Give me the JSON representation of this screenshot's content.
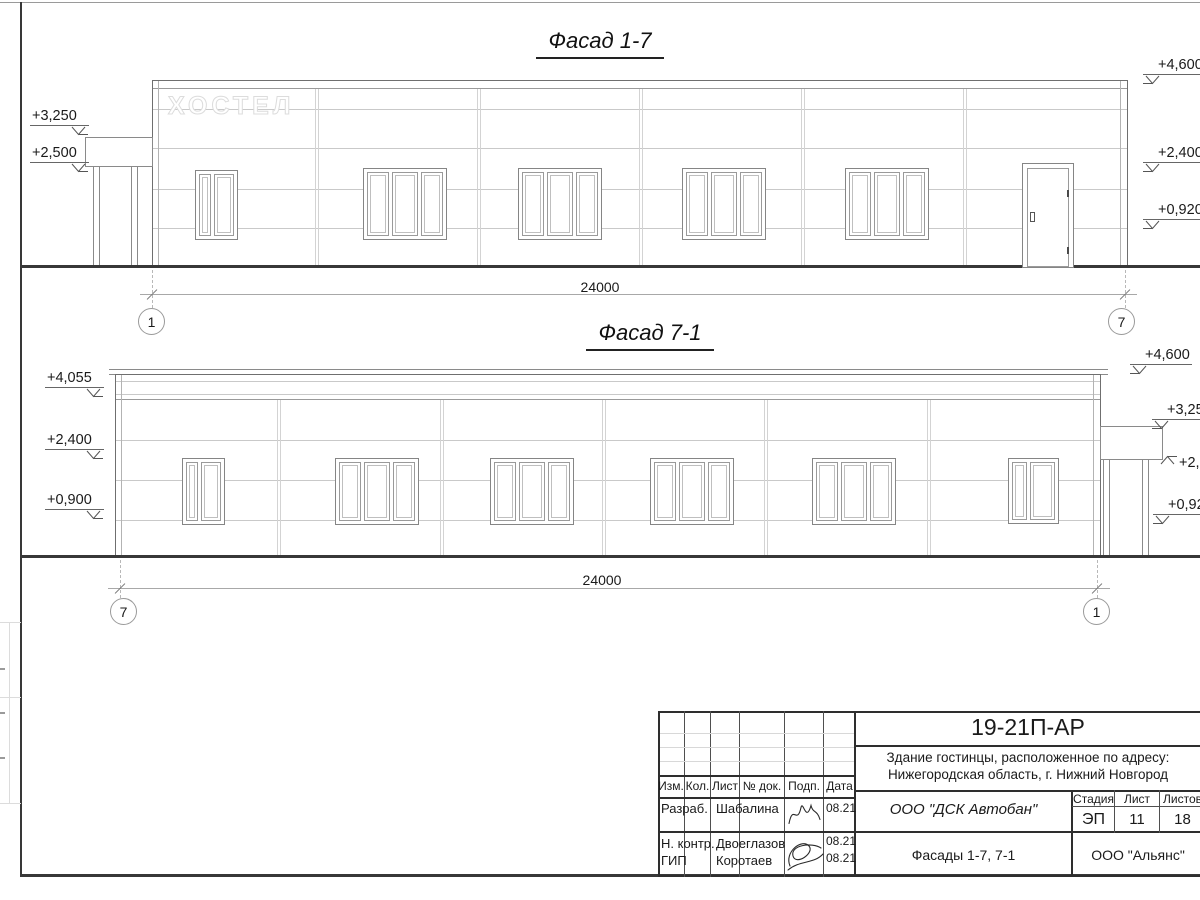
{
  "facade1": {
    "title": "Фасад 1-7",
    "sign": "ХОСТЕЛ",
    "marks_left": [
      "+3,250",
      "+2,500"
    ],
    "marks_right": [
      "+4,600",
      "+2,400",
      "+0,920"
    ],
    "dim": "24000",
    "axis_left": "1",
    "axis_right": "7"
  },
  "facade2": {
    "title": "Фасад 7-1",
    "marks_left": [
      "+4,055",
      "+2,400",
      "+0,900"
    ],
    "marks_right": [
      "+4,600",
      "+3,250",
      "+2,500",
      "+0,920"
    ],
    "dim": "24000",
    "axis_left": "7",
    "axis_right": "1"
  },
  "stamp": {
    "doc_code": "19-21П-АР",
    "object_line1": "Здание гостинцы, расположенное по адресу:",
    "object_line2": "Нижегородская область, г. Нижний Новгород",
    "org": "ООО \"ДСК Автобан\"",
    "drawing_name": "Фасады 1-7, 7-1",
    "contractor": "ООО \"Альянс\"",
    "stage_label": "Стадия",
    "sheet_label": "Лист",
    "sheets_label": "Листов",
    "stage": "ЭП",
    "sheet": "11",
    "sheets": "18",
    "col_izm": "Изм.",
    "col_kol": "Кол.",
    "col_list": "Лист",
    "col_doc": "№ док.",
    "col_sign": "Подп.",
    "col_date": "Дата",
    "row1_role": "Разраб.",
    "row1_name": "Шабалина",
    "row1_date": "08.21",
    "row2_role": "Н. контр.",
    "row2_name": "Двоеглазов",
    "row2_date": "08.21",
    "row3_role": "ГИП",
    "row3_name": "Коротаев",
    "row3_date": "08.21"
  }
}
